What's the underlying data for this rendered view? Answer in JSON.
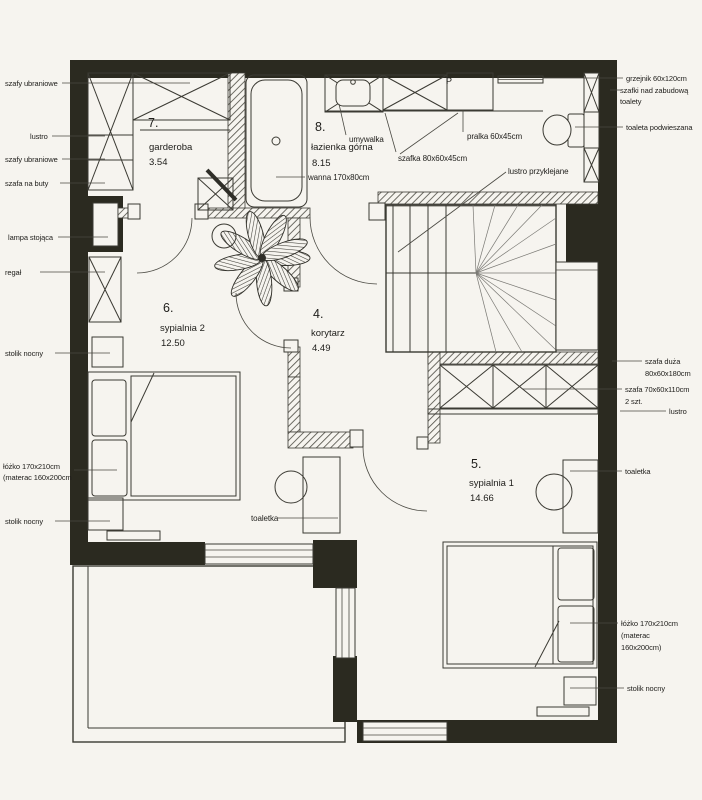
{
  "colors": {
    "wall": "#2b2a20",
    "line": "#3b3a33",
    "paper": "#f6f4ef"
  },
  "rooms": [
    {
      "num": "7.",
      "name": "garderoba",
      "area": "3.54"
    },
    {
      "num": "8.",
      "name": "łazienka górna",
      "area": "8.15"
    },
    {
      "num": "6.",
      "name": "sypialnia 2",
      "area": "12.50"
    },
    {
      "num": "4.",
      "name": "korytarz",
      "area": "4.49"
    },
    {
      "num": "5.",
      "name": "sypialnia 1",
      "area": "14.66"
    }
  ],
  "left": {
    "l1": "szafy ubraniowe",
    "l2": "lustro",
    "l3": "szafy ubraniowe",
    "l4": "szafa na buty",
    "l5": "lampa stojąca",
    "l6": "regał",
    "l7": "stolik nocny",
    "l8a": "łóżko 170x210cm",
    "l8b": "(materac 160x200cm",
    "l9": "stolik nocny"
  },
  "right": {
    "r1": "grzejnik 60x120cm",
    "r2a": "szafki nad zabudową",
    "r2b": "toalety",
    "r3": "toaleta podwieszana",
    "r4a": "szafa duża",
    "r4b": "80x60x180cm",
    "r5a": "szafa 70x60x110cm",
    "r5b": "2 szt.",
    "r6": "lustro",
    "r7": "toaletka",
    "r8a": "łóżko 170x210cm",
    "r8b": "(materac",
    "r8c": "160x200cm)",
    "r9": "stolik nocny"
  },
  "inner": {
    "umywalka": "umywalka",
    "szafka": "szafka 80x60x45cm",
    "pralka": "pralka 60x45cm",
    "pralka_mark": "P",
    "wanna": "wanna 170x80cm",
    "lustro_przyklejane": "lustro przyklejane",
    "toaletka6": "toaletka"
  }
}
